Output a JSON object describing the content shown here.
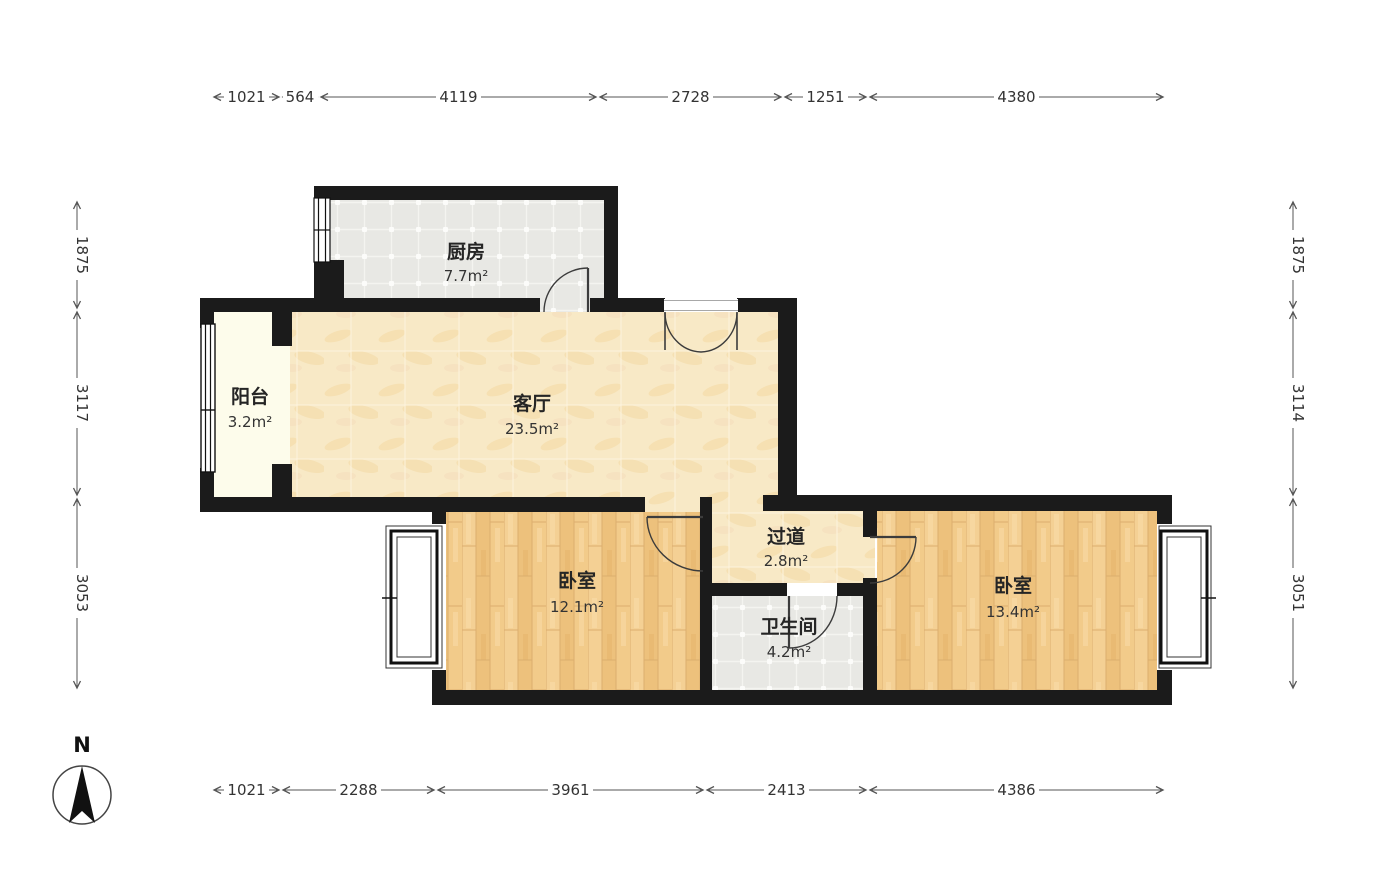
{
  "compass": {
    "label": "N"
  },
  "rooms": [
    {
      "id": "kitchen",
      "name": "厨房",
      "area": "7.7m²"
    },
    {
      "id": "balcony",
      "name": "阳台",
      "area": "3.2m²"
    },
    {
      "id": "living-room",
      "name": "客厅",
      "area": "23.5m²"
    },
    {
      "id": "hallway",
      "name": "过道",
      "area": "2.8m²"
    },
    {
      "id": "bedroom-left",
      "name": "卧室",
      "area": "12.1m²"
    },
    {
      "id": "bathroom",
      "name": "卫生间",
      "area": "4.2m²"
    },
    {
      "id": "bedroom-right",
      "name": "卧室",
      "area": "13.4m²"
    }
  ],
  "dimensions": {
    "top": [
      "1021",
      "564",
      "4119",
      "2728",
      "1251",
      "4380"
    ],
    "bottom": [
      "1021",
      "2288",
      "3961",
      "2413",
      "4386"
    ],
    "left": [
      "1875",
      "3117",
      "3053"
    ],
    "right": [
      "1875",
      "3114",
      "3051"
    ]
  },
  "colors": {
    "wall": "#1b1b1b",
    "tile_gray": "#e8e8e4",
    "floor_tan": "#f8e9c6",
    "wood": "#f1c988",
    "balcony": "#fdfceb",
    "dimension_line": "#555555"
  }
}
